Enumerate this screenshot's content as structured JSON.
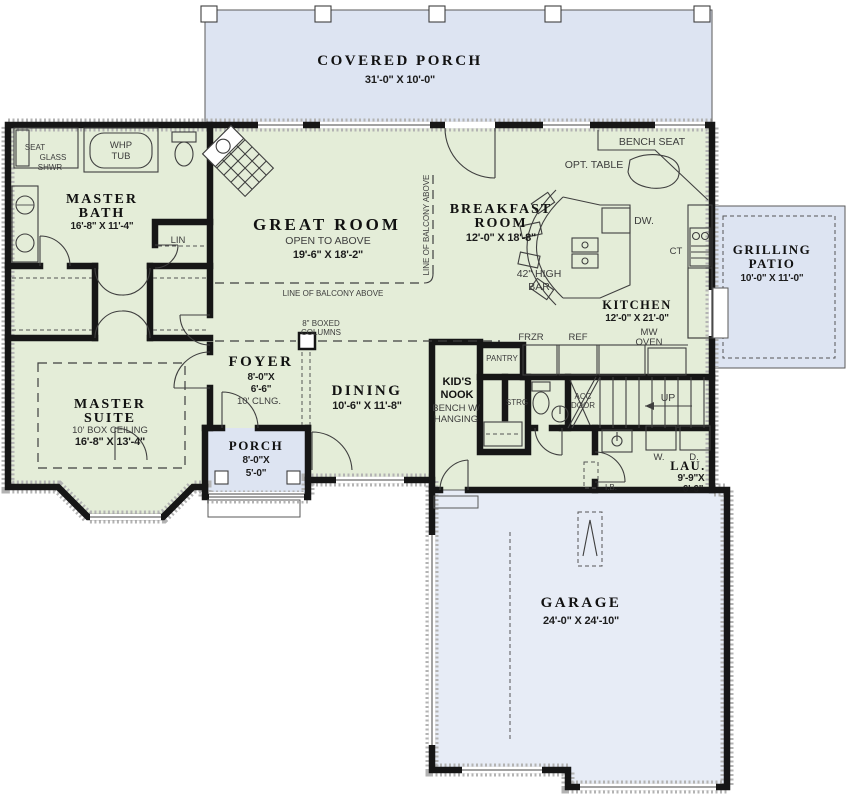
{
  "plan": {
    "rooms": {
      "covered_porch": {
        "name": "COVERED PORCH",
        "dims": "31'-0\" X 10'-0\""
      },
      "great_room": {
        "name": "GREAT ROOM",
        "note": "OPEN TO ABOVE",
        "dims": "19'-6\" X 18'-2\""
      },
      "breakfast_room": {
        "name_1": "BREAKFAST",
        "name_2": "ROOM",
        "dims": "12'-0\" X 18'-8\""
      },
      "kitchen": {
        "name": "KITCHEN",
        "dims": "12'-0\" X 21'-0\""
      },
      "master_bath": {
        "name_1": "MASTER",
        "name_2": "BATH",
        "dims": "16'-8\" X 11'-4\""
      },
      "master_suite": {
        "name_1": "MASTER",
        "name_2": "SUITE",
        "note": "10' BOX CEILING",
        "dims": "16'-8\" X 13'-4\""
      },
      "foyer": {
        "name": "FOYER",
        "dims_1": "8'-0\"X",
        "dims_2": "6'-6\"",
        "note": "10' CLNG."
      },
      "dining": {
        "name": "DINING",
        "dims": "10'-6\" X 11'-8\""
      },
      "kids_nook": {
        "name_1": "KID'S",
        "name_2": "NOOK",
        "note_1": "BENCH W/",
        "note_2": "HANGING"
      },
      "porch": {
        "name": "PORCH",
        "dims_1": "8'-0\"X",
        "dims_2": "5'-0\""
      },
      "laundry": {
        "name": "LAU.",
        "dims_1": "9'-9\"X",
        "dims_2": "6'-6\""
      },
      "garage": {
        "name": "GARAGE",
        "dims": "24'-0\" X 24'-10\""
      },
      "grilling_patio": {
        "name_1": "GRILLING",
        "name_2": "PATIO",
        "dims": "10'-0\" X 11'-0\""
      }
    },
    "fixtures": {
      "whp_1": "WHP",
      "whp_2": "TUB",
      "seat": "SEAT",
      "glass_1": "GLASS",
      "glass_2": "SHWR",
      "lin": "LIN",
      "bench_seat": "BENCH SEAT",
      "opt_table": "OPT. TABLE",
      "dw": "DW.",
      "ct": "CT",
      "bar_1": "42\" HIGH",
      "bar_2": "BAR",
      "frzr": "FRZR",
      "ref": "REF",
      "mw_1": "MW",
      "mw_2": "OVEN",
      "pantry": "PANTRY",
      "strg": "STRG",
      "acc_1": "ACC",
      "acc_2": "DOOR",
      "up": "UP",
      "washer": "W.",
      "dryer": "D.",
      "ib": "I.B.",
      "columns_1": "8\" BOXED",
      "columns_2": "COLUMNS",
      "balcony": "LINE OF BALCONY ABOVE"
    },
    "colors": {
      "room": "#e4edd8",
      "porch": "#dde4f2",
      "garage": "#e7ecf6",
      "wall": "#161616",
      "text": "#111111"
    }
  }
}
